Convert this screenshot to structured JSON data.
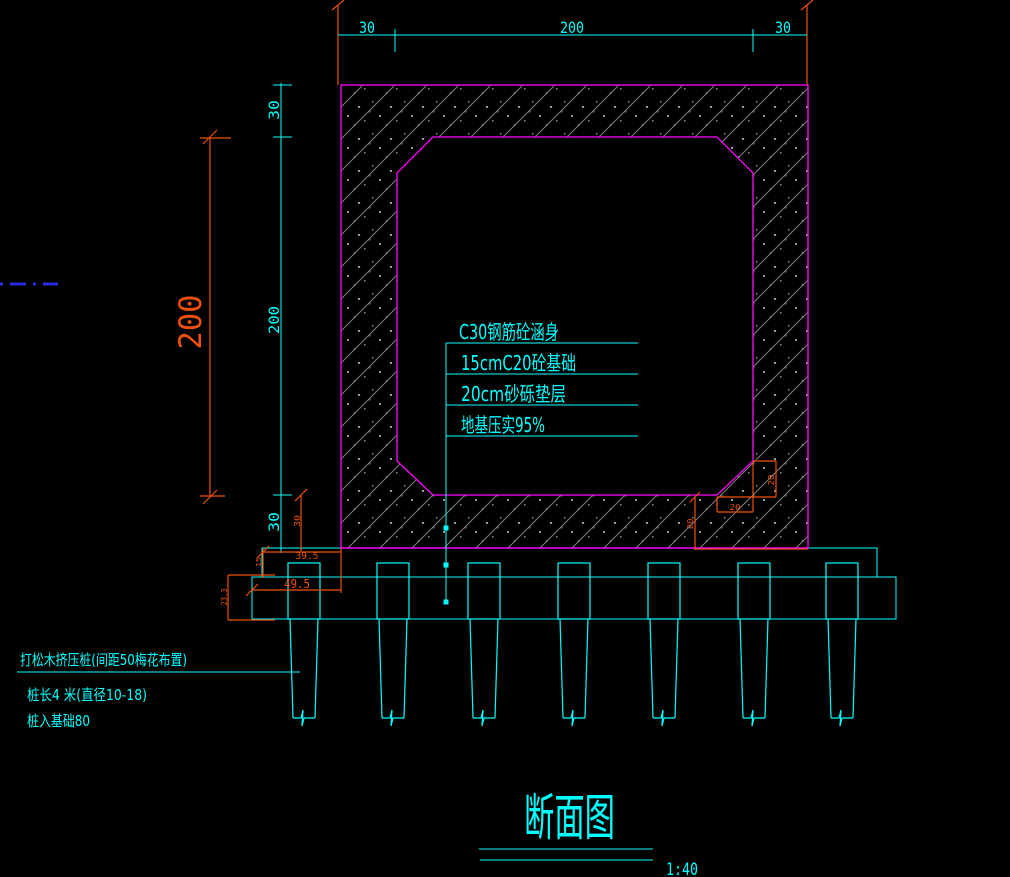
{
  "canvas": {
    "background": "#000000"
  },
  "colors": {
    "annotation_cyan": "#00ffff",
    "outline_magenta": "#ff00ff",
    "dimension_orange": "#ed4f0c",
    "hatch_gray": "#7f7f7f",
    "centerline_blue": "#2a2ae0"
  },
  "dimensions": {
    "top": {
      "left": "30",
      "center": "200",
      "right": "30"
    },
    "left_chain": {
      "top": "30",
      "middle": "200",
      "bottom": "30"
    },
    "inner_height": "200",
    "detail": {
      "slab_thickness": "30",
      "footing_offset_upper": "39.5",
      "footing_offset_lower": "49.5",
      "layer1_thickness": "15",
      "layer2_thickness": "23.3",
      "chamfer_width": "20",
      "chamfer_height": "20",
      "corner_drop": "20"
    }
  },
  "callouts": {
    "lines": [
      "C30钢筋砼涵身",
      "15cmC20砼基础",
      "20cm砂砾垫层",
      "地基压实95%"
    ]
  },
  "pile_note": {
    "line1": "打松木挤压桩(间距50梅花布置)",
    "line2": "桩长4 米(直径10-18)",
    "line3": "桩入基础80"
  },
  "title": {
    "text": "断面图",
    "scale": "1:40"
  }
}
